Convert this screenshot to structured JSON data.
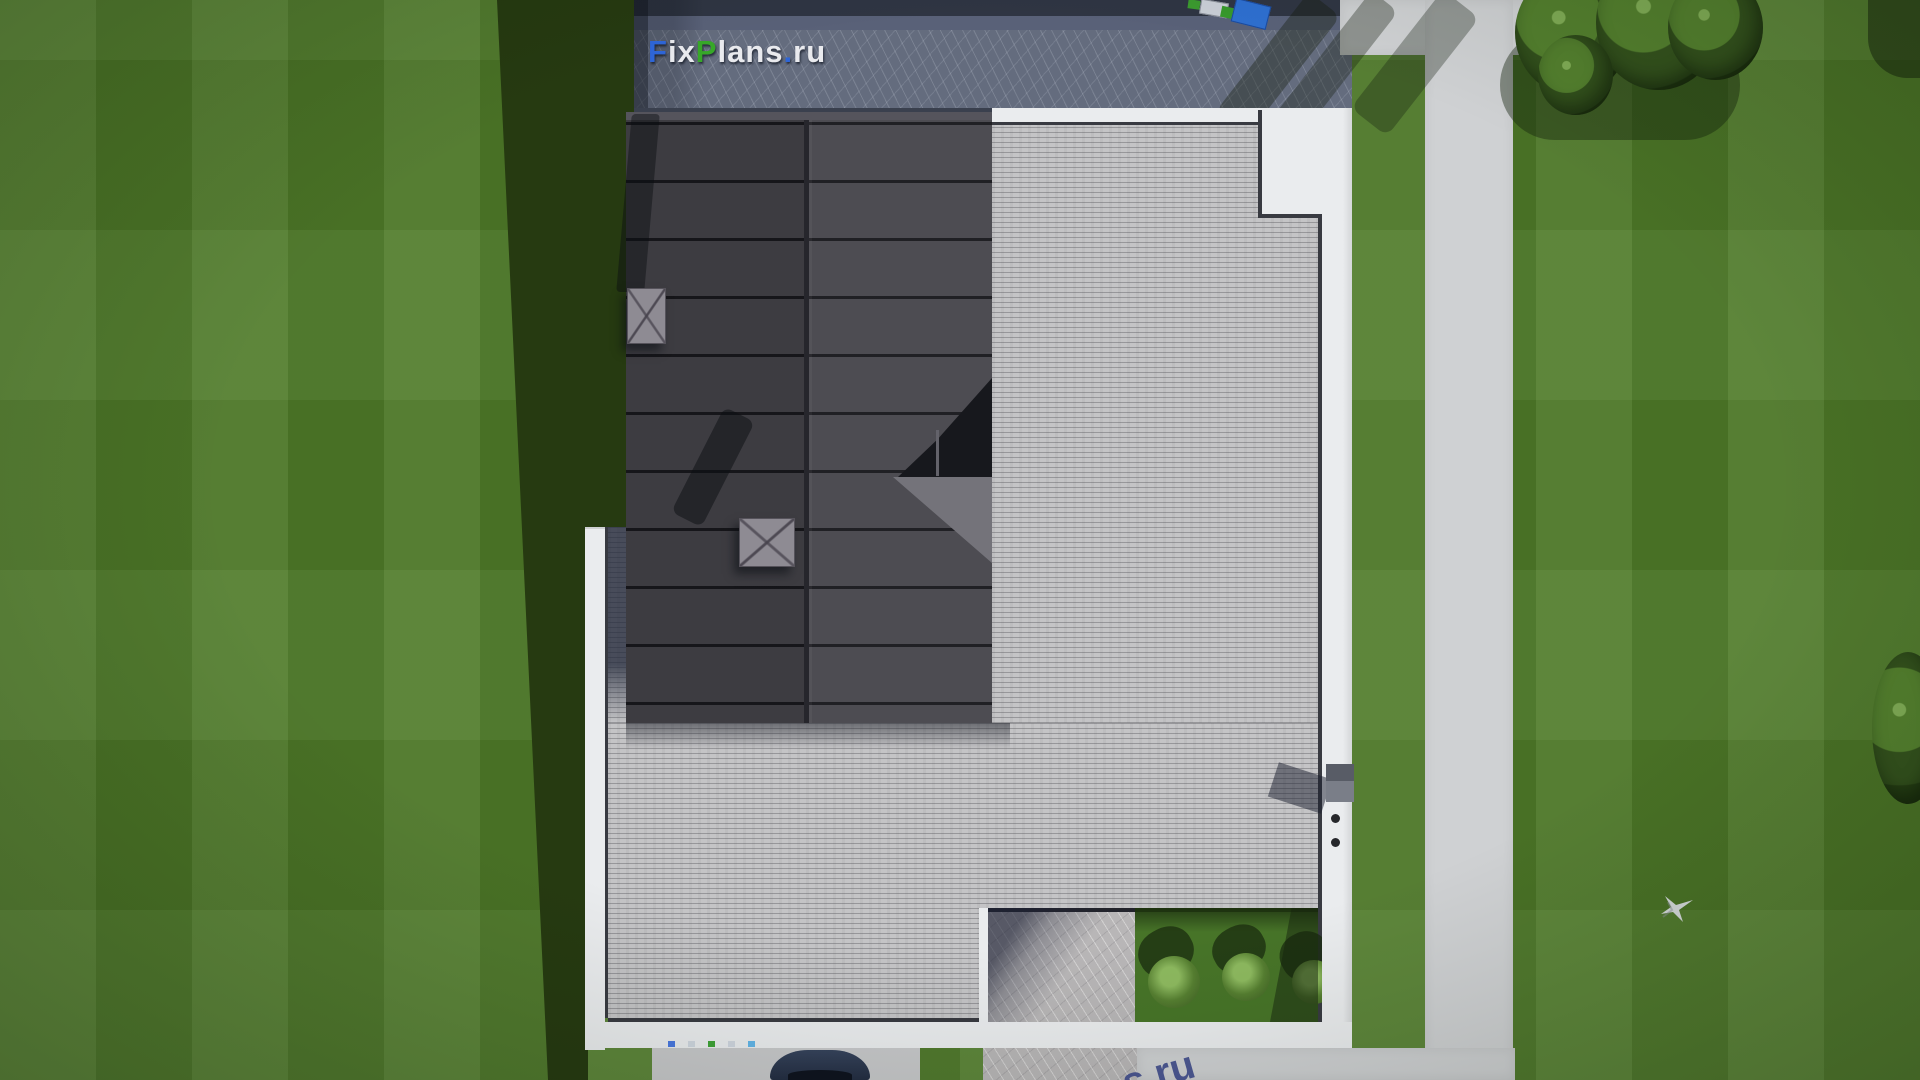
{
  "watermark": {
    "site_text": "FixPlans.ru",
    "letters": [
      {
        "text": "F",
        "color": "#2e66d8"
      },
      {
        "text": "ix",
        "color": "#e9eaee"
      },
      {
        "text": "P",
        "color": "#37a829"
      },
      {
        "text": "lans",
        "color": "#e9eaee"
      },
      {
        "text": ".",
        "color": "#2e66d8"
      },
      {
        "text": "ru",
        "color": "#e9eaee"
      }
    ],
    "bottom_fragment": "s.ru"
  },
  "scene": {
    "description": "Aerial top-down 3D render of a modern flat-roof house: dark standing-seam roof, wood deck terrace with white parapets, stone driveway band at top, lawn with mowing stripes, walkway on right, trees, bushes, a car and a flying bird",
    "colors": {
      "lawn": "#4f7b29",
      "lawn_shadow": "#263a11",
      "roof_dark": "#454449",
      "deck": "#c4c4c6",
      "parapet_white": "#eaecee",
      "stone_band": "#646c7e",
      "patio_stone": "#b8b6b7",
      "walkway": "#cfd1d3",
      "car_body": "#2c3850",
      "truck_container_blue": "#2e6fd0",
      "truck_green": "#3b9a2f",
      "bush_green": "#6fa04a",
      "tree_green": "#33511d",
      "bird": "#d7dade"
    },
    "objects": [
      "lawn",
      "house-cast-shadow",
      "stone-driveway-band",
      "metal-roof",
      "chimneys",
      "glass-dormer",
      "wood-deck-terrace",
      "white-parapets",
      "roof-access-block",
      "parapet-vent",
      "patio-cutout",
      "garden-cutout-with-bushes",
      "top-path",
      "right-walkway",
      "bottom-driveway",
      "parked-car",
      "delivery-truck",
      "trees",
      "flying-bird"
    ]
  }
}
